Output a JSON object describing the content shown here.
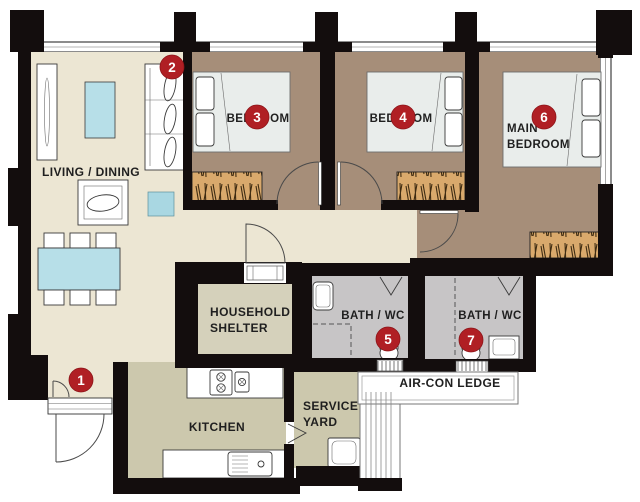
{
  "plan": {
    "rooms": {
      "living_dining": "LIVING / DINING",
      "bedroom3": "BEDROOM",
      "bedroom4": "BEDROOM",
      "main_bedroom_line1": "MAIN",
      "main_bedroom_line2": "BEDROOM",
      "household_shelter_line1": "HOUSEHOLD",
      "household_shelter_line2": "SHELTER",
      "bath5": "BATH / WC",
      "bath7": "BATH / WC",
      "kitchen": "KITCHEN",
      "service_yard_line1": "SERVICE",
      "service_yard_line2": "YARD",
      "aircon_ledge": "AIR-CON LEDGE"
    },
    "markers": {
      "m1": "1",
      "m2": "2",
      "m3": "3",
      "m4": "4",
      "m5": "5",
      "m6": "6",
      "m7": "7"
    },
    "colors": {
      "wall": "#130d0d",
      "living_floor": "#ECE6D3",
      "bedroom_floor": "#A68E79",
      "bath_floor": "#C7C5C6",
      "kitchen_floor": "#CCC8AD",
      "shelter_floor": "#D5D1BB",
      "wardrobe": "#D9A96C",
      "water_blue": "#B7DFE8",
      "water_blue2": "#A9D7E2",
      "bed": "#E9EDEB",
      "marker_red": "#B01F24"
    }
  }
}
